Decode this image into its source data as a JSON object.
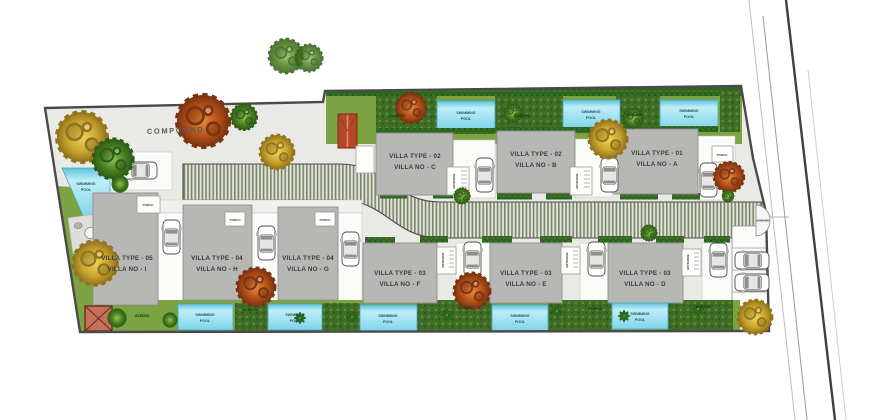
{
  "plan": {
    "compound_label": "COMPOUND",
    "swimming_pool_line1": "SWIMMING",
    "swimming_pool_line2": "POOL",
    "garden_label": "GARDEN",
    "porch_label": "PORCH",
    "entrance_label": "ENTRANCE",
    "villas": [
      {
        "id": "C",
        "type_label": "VILLA TYPE - 02",
        "no_label": "VILLA NO - C"
      },
      {
        "id": "B",
        "type_label": "VILLA TYPE - 02",
        "no_label": "VILLA NO - B"
      },
      {
        "id": "A",
        "type_label": "VILLA TYPE - 01",
        "no_label": "VILLA NO - A"
      },
      {
        "id": "I",
        "type_label": "VILLA TYPE - 05",
        "no_label": "VILLA NO - I"
      },
      {
        "id": "H",
        "type_label": "VILLA TYPE - 04",
        "no_label": "VILLA NO - H"
      },
      {
        "id": "G",
        "type_label": "VILLA TYPE - 04",
        "no_label": "VILLA NO - G"
      },
      {
        "id": "F",
        "type_label": "VILLA TYPE - 03",
        "no_label": "VILLA NO - F"
      },
      {
        "id": "E",
        "type_label": "VILLA TYPE - 03",
        "no_label": "VILLA NO - E"
      },
      {
        "id": "D",
        "type_label": "VILLA TYPE - 03",
        "no_label": "VILLA NO - D"
      }
    ],
    "colors": {
      "ground": "#e9e9e6",
      "boundary": "#4a4a4a",
      "villa_gray": "#b7b7b5",
      "pool_blue": "#8edcef",
      "lawn_green": "#7ba341",
      "garden_dark_green": "#3f6d27",
      "road_stripe_olive": "#7b8569",
      "tree_green": "#4a7d22",
      "tree_orange": "#b3501a",
      "tree_yellow": "#caa52e",
      "utility_red": "#c4715c"
    }
  }
}
